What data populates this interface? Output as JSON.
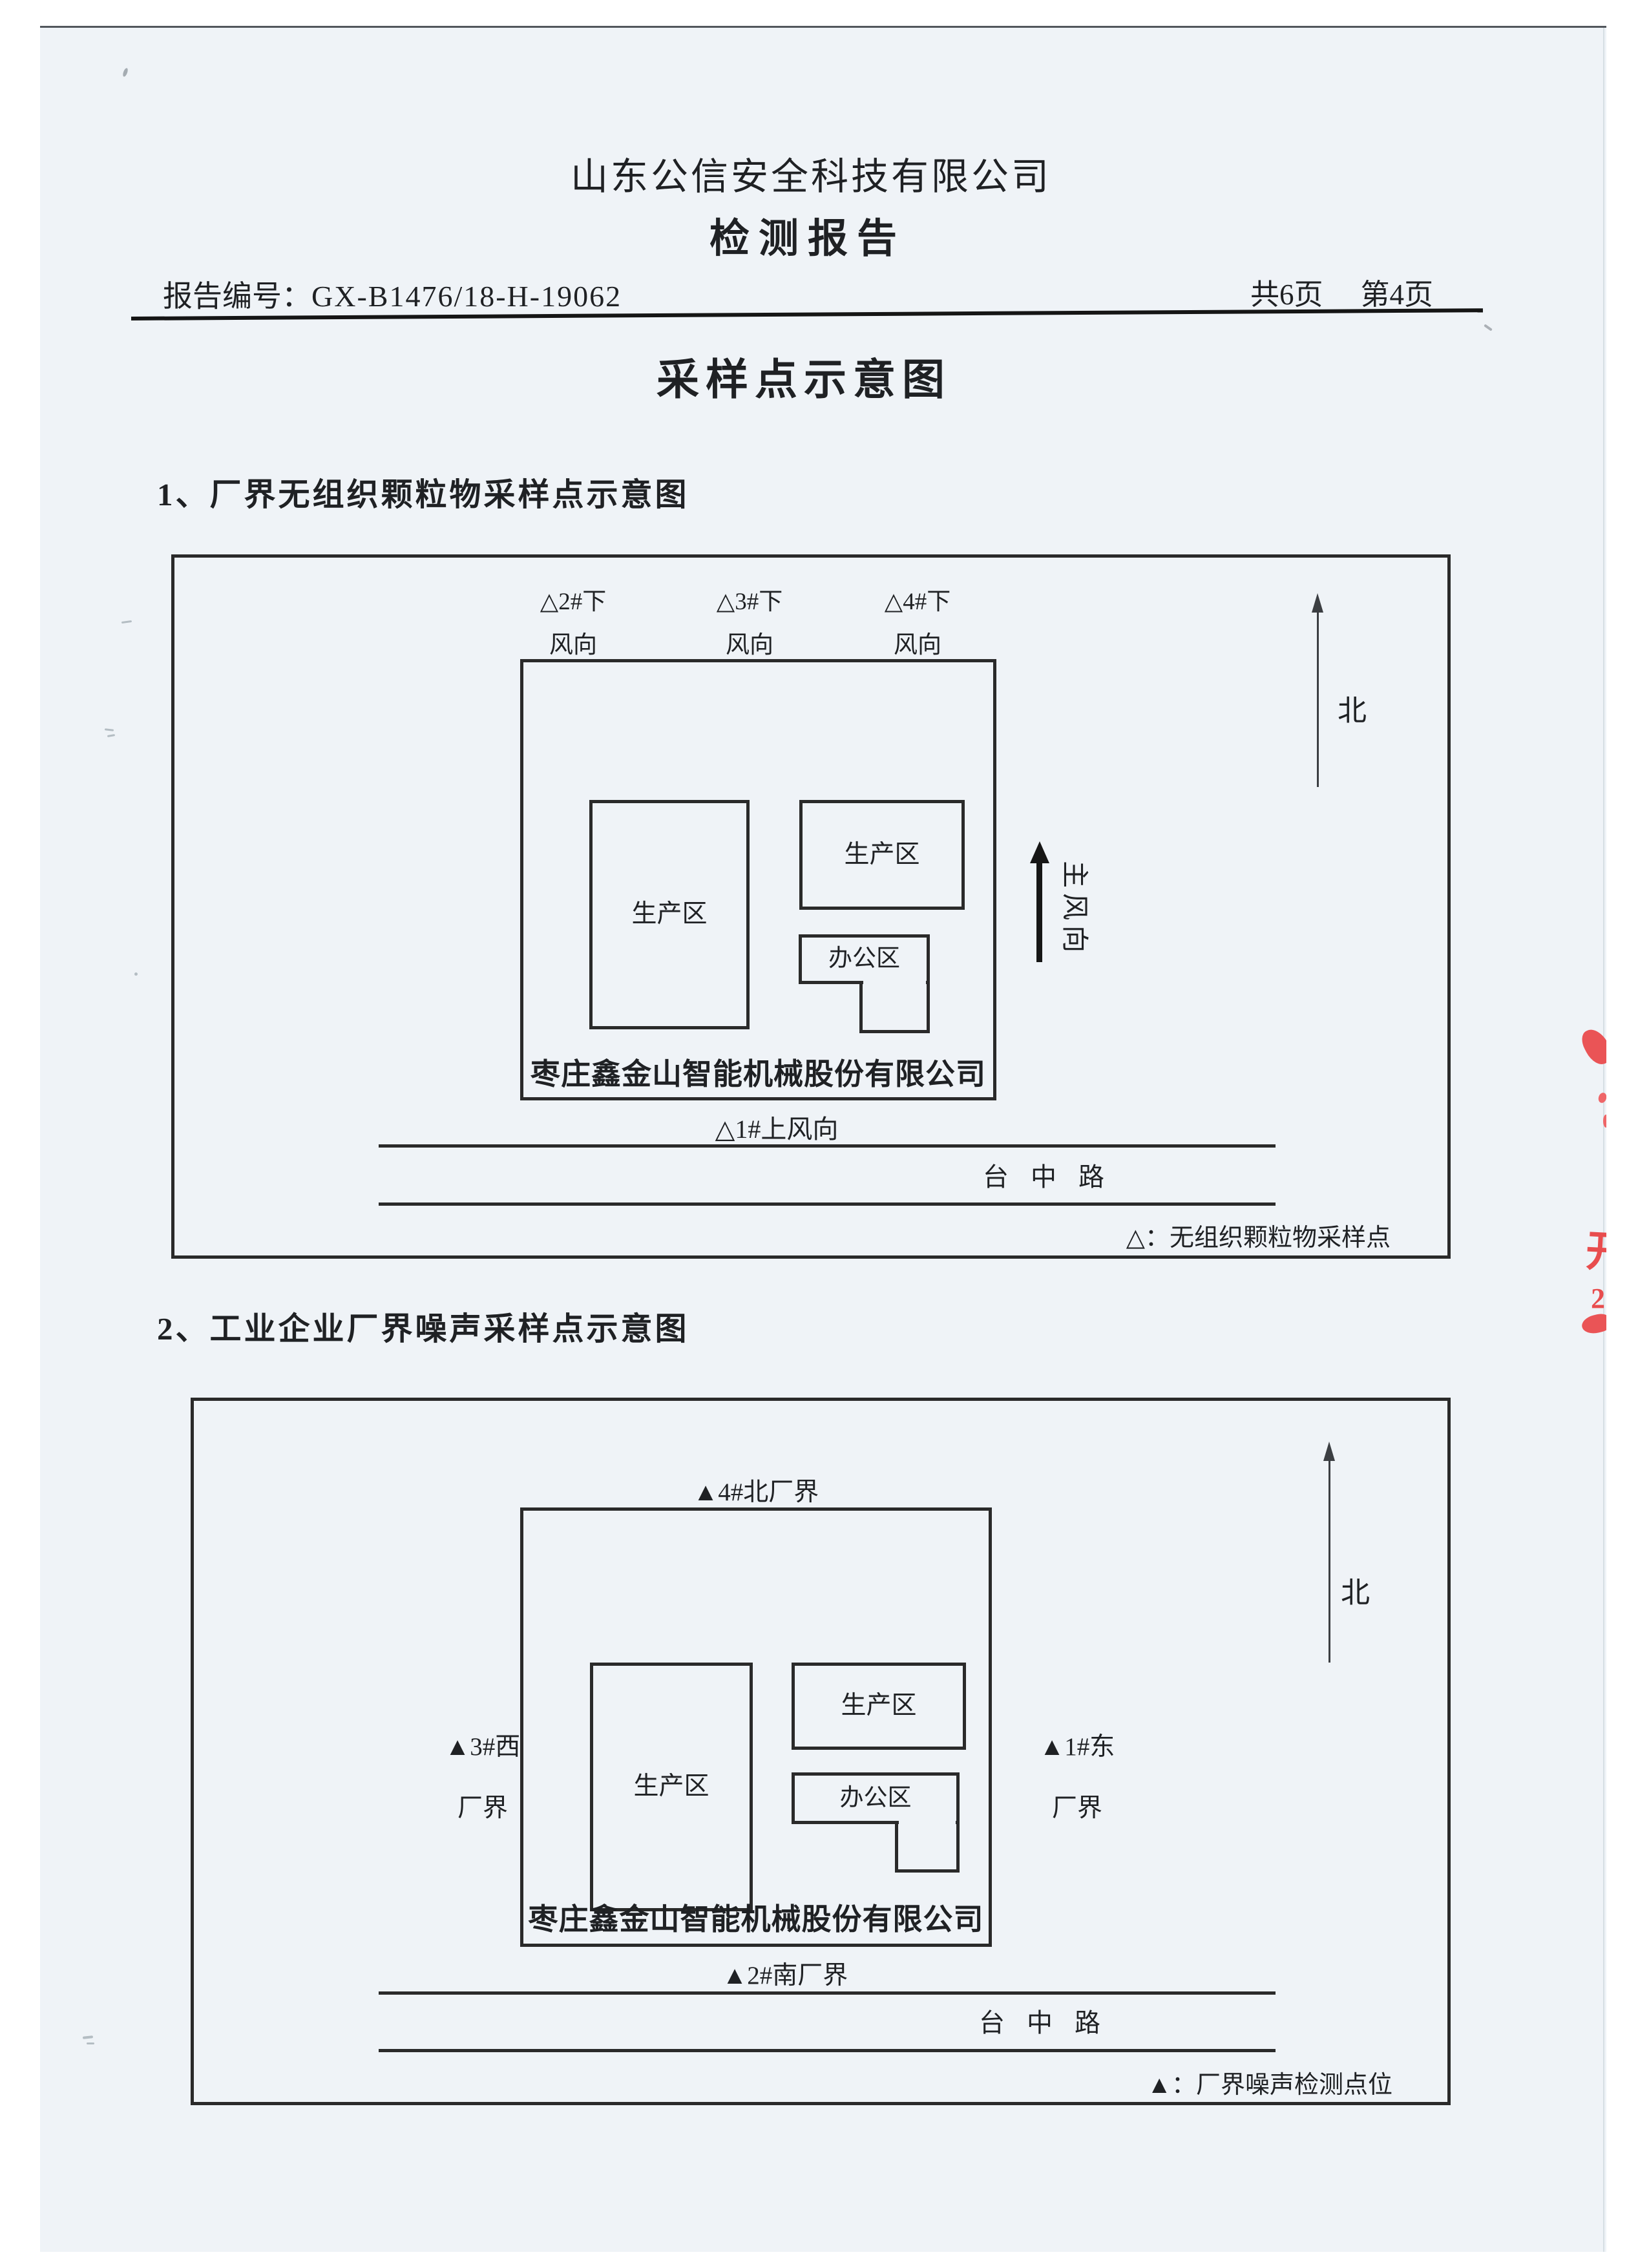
{
  "header": {
    "company": "山东公信安全科技有限公司",
    "doc_type": "检测报告",
    "report_no_label": "报告编号：",
    "report_no": "GX-B1476/18-H-19062",
    "pages_total": "共6页",
    "page_current": "第4页",
    "main_title": "采样点示意图"
  },
  "diagram1": {
    "heading": "1、厂界无组织颗粒物采样点示意图",
    "downwind_points": [
      {
        "line1": "△2#下",
        "line2": "风向"
      },
      {
        "line1": "△3#下",
        "line2": "风向"
      },
      {
        "line1": "△4#下",
        "line2": "风向"
      }
    ],
    "north_label": "北",
    "production_area_left": "生产区",
    "production_area_right": "生产区",
    "office_area": "办公区",
    "factory_name": "枣庄鑫金山智能机械股份有限公司",
    "main_wind_direction": "主风向",
    "upwind_point": "△1#上风向",
    "road_name": "台 中 路",
    "legend": "△：无组织颗粒物采样点"
  },
  "diagram2": {
    "heading": "2、工业企业厂界噪声采样点示意图",
    "north_point": "▲4#北厂界",
    "west_point_line1": "▲3#西",
    "west_point_line2": "厂界",
    "east_point_line1": "▲1#东",
    "east_point_line2": "厂界",
    "south_point": "▲2#南厂界",
    "north_label": "北",
    "production_area_left": "生产区",
    "production_area_right": "生产区",
    "office_area": "办公区",
    "factory_name": "枣庄鑫金山智能机械股份有限公司",
    "road_name": "台 中 路",
    "legend": "▲：厂界噪声检测点位"
  },
  "artifacts": {
    "stamp_fragment_char": "开",
    "stamp_fragment_digit": "2"
  },
  "colors": {
    "page_bg": "#eff3f7",
    "ink": "#1f2124",
    "stamp_red": "#e84d4e"
  }
}
